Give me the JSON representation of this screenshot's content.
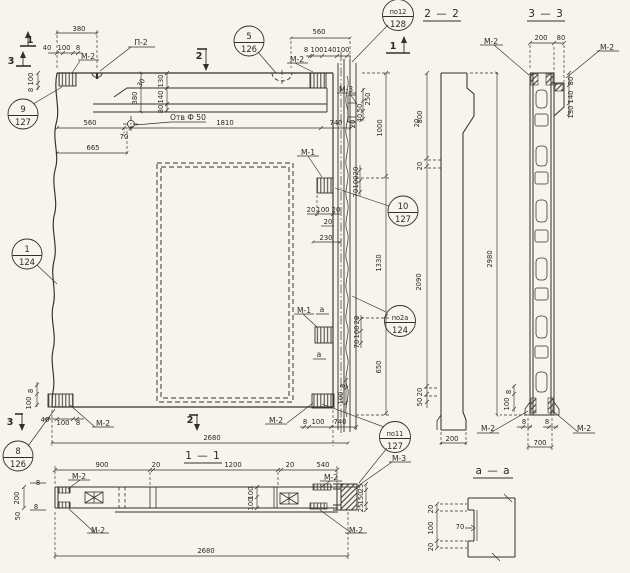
{
  "drawing": {
    "section_titles": {
      "s22": "2 — 2",
      "s33": "3 — 3",
      "s11": "1 — 1",
      "saa": "а — а"
    },
    "callouts": {
      "c9": {
        "num": "9",
        "sheet": "127"
      },
      "c1": {
        "num": "1",
        "sheet": "124"
      },
      "c8": {
        "num": "8",
        "sheet": "126"
      },
      "c5": {
        "num": "5",
        "sheet": "126"
      },
      "c12": {
        "num": "по12",
        "sheet": "128"
      },
      "c10": {
        "num": "10",
        "sheet": "127"
      },
      "c2a": {
        "num": "по2а",
        "sheet": "124"
      },
      "c11": {
        "num": "по11",
        "sheet": "127"
      }
    },
    "marks": {
      "p2": "П-2",
      "m1": "М-1",
      "m2": "М-2",
      "m3": "М-3"
    },
    "cut_labels": {
      "one": "1",
      "two": "2",
      "three": "3",
      "a": "а"
    },
    "notes": {
      "hole": "Отв Ф 50"
    },
    "dims": {
      "d8": "8",
      "d20": "20",
      "d25": "25",
      "d30": "30",
      "d40": "40",
      "d50": "50",
      "d70": "70",
      "d80": "80",
      "d100": "100",
      "d130": "130",
      "d140": "140",
      "d150": "150",
      "d200": "200",
      "d230": "230",
      "d250": "250",
      "d380": "380",
      "d540": "540",
      "d560": "560",
      "d650": "650",
      "d665": "665",
      "d700": "700",
      "d740": "740",
      "d800": "800",
      "d900": "900",
      "d1000": "1000",
      "d1200": "1200",
      "d1330": "1330",
      "d1810": "1810",
      "d2090": "2090",
      "d2680": "2680",
      "d2980": "2980"
    },
    "colors": {
      "ink": "#332f29",
      "paper": "#f6f4ee"
    }
  }
}
